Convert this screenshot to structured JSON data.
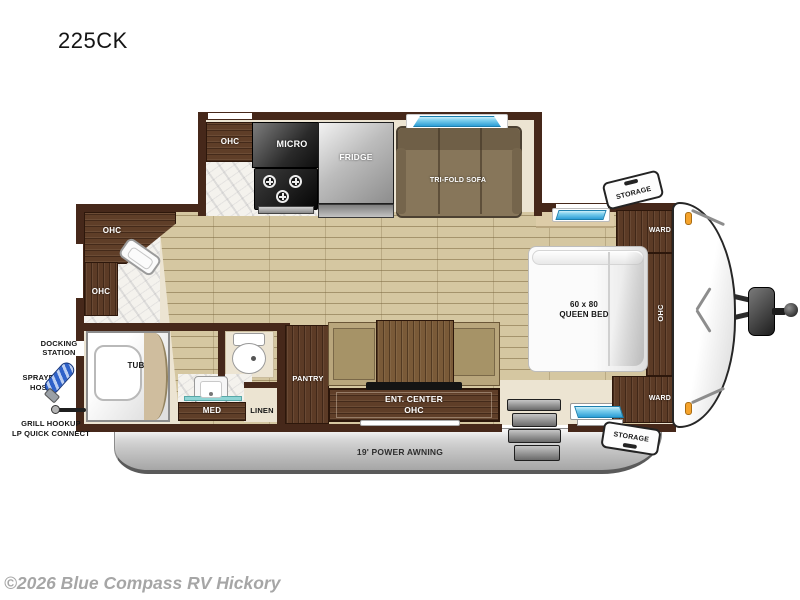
{
  "title": "225CK",
  "watermark": "©2026 Blue Compass RV Hickory",
  "floorplan_type": "travel-trailer-floorplan",
  "colors": {
    "wall": "#46281a",
    "cabinet_wood": "#5c3b26",
    "floor_plank": "#d5c7a1",
    "interior_cream": "#ece4d2",
    "window_blue": "#2d9ed6",
    "skirt_gray": "#bdbdbd",
    "marker_orange": "#f5a32c",
    "sofa_brown": "#87765a"
  },
  "labels": {
    "kitchen_ohc": "OHC",
    "micro": "MICRO",
    "fridge": "FRIDGE",
    "trifold_sofa": "TRI-FOLD SOFA",
    "storage_top": "STORAGE",
    "storage_bottom": "STORAGE",
    "ward_top": "WARD",
    "ward_bottom": "WARD",
    "bed": "60 x 80\nQUEEN BED",
    "bed_ohc": "OHC",
    "corner_ohc": "OHC",
    "side_ohc": "OHC",
    "docking": "DOCKING\nSTATION",
    "sprayer": "SPRAYER\nHOSE",
    "grill": "GRILL HOOKUP\nLP QUICK CONNECT",
    "tub": "TUB",
    "med": "MED",
    "linen": "LINEN",
    "pantry": "PANTRY",
    "ent_center": "ENT. CENTER\nOHC",
    "awning": "19' POWER AWNING"
  }
}
